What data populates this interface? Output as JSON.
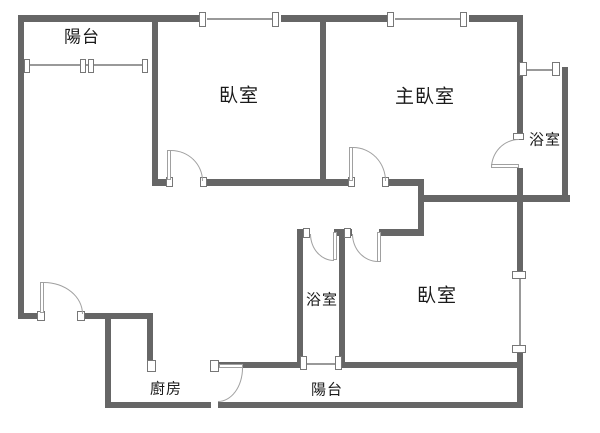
{
  "title": "apartment-floor-plan",
  "colors": {
    "wall": "#666666",
    "wall_edge": "#777777",
    "thin_line": "#999999",
    "arc": "#a0a0a0",
    "text": "#1a1a1a",
    "background": "#ffffff"
  },
  "rooms": {
    "balcony_top": {
      "label": "陽台"
    },
    "bedroom_top": {
      "label": "臥室"
    },
    "master_bedroom": {
      "label": "主臥室"
    },
    "bathroom_upper": {
      "label": "浴室"
    },
    "bathroom_lower": {
      "label": "浴室"
    },
    "bedroom_bottom": {
      "label": "臥室"
    },
    "kitchen": {
      "label": "廚房"
    },
    "balcony_bottom": {
      "label": "陽台"
    }
  }
}
